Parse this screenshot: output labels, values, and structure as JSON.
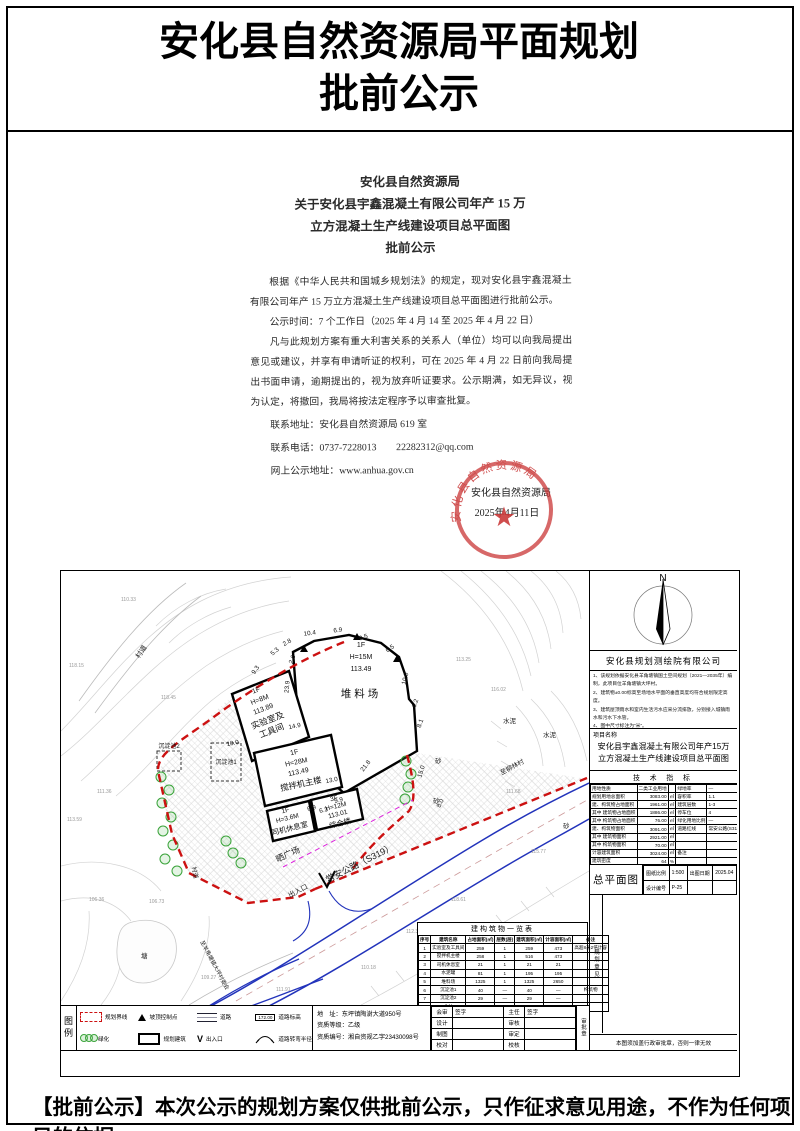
{
  "colors": {
    "boundary_red": "#cc1111",
    "road_blue": "#2233bb",
    "tree_green": "#3aa33a",
    "seal_red": "#c93535",
    "magenta": "#dd22dd"
  },
  "page": {
    "title_line1": "安化县自然资源局平面规划",
    "title_line2": "批前公示",
    "footer": "【批前公示】本次公示的规划方案仅供批前公示，只作征求意见用途，不作为任何项目的依据。"
  },
  "notice": {
    "title1": "安化县自然资源局",
    "title2": "关于安化县宇鑫混凝土有限公司年产 15 万",
    "title3": "立方混凝土生产线建设项目总平面图",
    "title4": "批前公示",
    "p1": "根据《中华人民共和国城乡规划法》的规定，现对安化县宇鑫混凝土有限公司年产 15 万立方混凝土生产线建设项目总平面图进行批前公示。",
    "p2": "公示时间：7 个工作日（2025 年 4 月 14 至 2025 年 4 月 22 日）",
    "p3": "凡与此规划方案有重大利害关系的关系人（单位）均可以向我局提出意见或建议，并享有申请听证的权利，可在 2025 年 4 月 22 日前向我局提出书面申请，逾期提出的，视为放弃听证要求。公示期满，如无异议，视为认定，将撤回，我局将按法定程序予以审查批复。",
    "contact_address": "联系地址：安化县自然资源局 619 室",
    "contact_phone": "联系电话：0737-7228013　　22282312@qq.com",
    "contact_web": "网上公示地址：www.anhua.gov.cn",
    "issuer": "安化县自然资源局",
    "date": "2025年4月11日",
    "seal_text": "安化县自然资源局",
    "seal_star": "★"
  },
  "map": {
    "labels": {
      "road_main": "常安公路（S319）",
      "road_branch": "至羊角塘镇大坪村委会",
      "road_dir": "至柳林村",
      "village_road": "村道",
      "village_road2": "村道",
      "plaza": "晒广场",
      "entrance": "出入口",
      "pond": "塘",
      "sand": "砂",
      "cement": "水泥",
      "tank1": "沉淀池1",
      "tank2": "沉淀池2",
      "lab": [
        "1F",
        "H=8M",
        "113.89",
        "实验室及",
        "工具间"
      ],
      "yard": [
        "1F",
        "H=15M",
        "113.49",
        "堆料场"
      ],
      "mixer": [
        "1F",
        "H=28M",
        "113.49",
        "搅拌机主楼"
      ],
      "driver": [
        "1F",
        "H=3.6M",
        "司机休息室"
      ],
      "complex": [
        "3F",
        "H=12M",
        "113.01",
        "综合楼"
      ]
    },
    "dims": [
      "9.3",
      "5.3",
      "2.8",
      "2.6",
      "10.4",
      "6.9",
      "9.5",
      "6.5",
      "10.0",
      "6.2",
      "8.1",
      "23.9",
      "14.9",
      "13.0",
      "21.8",
      "15.0",
      "8.0",
      "9.9",
      "6.9",
      "6.3",
      "10.0"
    ],
    "elevations": [
      "118.15",
      "110.33",
      "118.45",
      "113.59",
      "111.36",
      "106.36",
      "106.73",
      "109.27",
      "111.91",
      "110.18",
      "112.31",
      "118.61",
      "115.77",
      "111.68",
      "116.02",
      "113.25"
    ]
  },
  "panel": {
    "north": "N",
    "company": "安化县规划测绘院有限公司",
    "notes": [
      "1、该规划依据安化县羊角塘镇国土空间规划（2021—2035年）编制，此项目位羊角塘镇大坪村。",
      "2、建筑物±0.00标高至场地水平面的垂直高度均符合规划限定高度。",
      "3、建筑屋顶雨水和室内生活污水应采分流排放，分别接入城镇雨水和污水下水管。",
      "4、图中尺寸标注为“米”。",
      "5、规划期限为2年。"
    ],
    "project_label": "项目名称",
    "project_name": "安化县宇鑫混凝土有限公司年产15万 立方混凝土生产线建设项目总平面图",
    "tech_title": "技 术 指 标",
    "tech_rows": [
      [
        "用地性质",
        "二类工业用地",
        "",
        "绿地率",
        "—"
      ],
      [
        "规划用地总面积",
        "3083.00",
        "㎡",
        "容积率",
        "1.1"
      ],
      [
        "建、构筑物占地面积",
        "1961.00",
        "㎡",
        "建筑层数",
        "1-3"
      ],
      [
        "其中 建筑物占地面积",
        "1886.00",
        "㎡",
        "停车位",
        "4"
      ],
      [
        "其中 构筑物占地面积",
        "76.00",
        "㎡",
        "绿化用地比例",
        "—"
      ],
      [
        "建、构筑物面积",
        "3091.00",
        "㎡",
        "道路红线",
        "常安公路(S319)"
      ],
      [
        "其中 建筑物面积",
        "2921.00",
        "㎡",
        "",
        ""
      ],
      [
        "其中 构筑物面积",
        "70.00",
        "㎡",
        "",
        ""
      ],
      [
        "计容建筑面积",
        "3024.00",
        "㎡",
        "备注",
        ""
      ],
      [
        "建筑密度",
        "64",
        "%",
        "",
        ""
      ]
    ],
    "master": "总平面图",
    "master_rows": [
      [
        "图纸比例",
        "1:500",
        "出图日期",
        "2025.04"
      ],
      [
        "设计编号",
        "P-25",
        "",
        ""
      ]
    ],
    "review_vert": "规划意见",
    "stamp_note": "本图须加盖行政审批章，否则一律无效"
  },
  "legend": {
    "title": "图例",
    "row1": [
      "规划界线",
      "坡顶控制点",
      "道路",
      "道路标高"
    ],
    "row2": [
      "绿化",
      "规划建筑",
      "出入口",
      "道路转弯半径"
    ],
    "elev_sample": "172.00",
    "gate_symbol": "V",
    "address1": "地　址：东坪镇陶澍大道950号",
    "address2": "资质等级：乙级",
    "address3": "资质编号：湘自资规乙字23430098号",
    "stamp_vert": "审批章",
    "sig_rows": [
      [
        "会审",
        "签字",
        "主任",
        "签字"
      ],
      [
        "设计",
        "",
        "审核",
        ""
      ],
      [
        "制图",
        "",
        "审定",
        ""
      ],
      [
        "校对",
        "",
        "校核",
        ""
      ]
    ]
  },
  "buildings": {
    "caption": "建构筑物一览表",
    "rows": [
      [
        "序号",
        "建筑名称",
        "占地面积(㎡)",
        "层数(层)",
        "建筑面积(㎡)",
        "计容面积(㎡)",
        "备注"
      ],
      [
        "1",
        "实验室及工具间",
        "259",
        "1",
        "259",
        "473",
        "高超8米2倍计容"
      ],
      [
        "2",
        "搅拌机主楼",
        "258",
        "1",
        "516",
        "473",
        ""
      ],
      [
        "3",
        "司机休息室",
        "21",
        "1",
        "21",
        "21",
        ""
      ],
      [
        "4",
        "水泥罐",
        "81",
        "1",
        "195",
        "195",
        ""
      ],
      [
        "5",
        "堆料场",
        "1325",
        "1",
        "1325",
        "2650",
        ""
      ],
      [
        "6",
        "沉淀池1",
        "40",
        "—",
        "40",
        "—",
        "构筑物"
      ],
      [
        "7",
        "沉淀池2",
        "29",
        "—",
        "29",
        "—",
        ""
      ],
      [
        "8",
        "合计",
        "1961",
        "—",
        "2091",
        "3024",
        ""
      ]
    ]
  }
}
